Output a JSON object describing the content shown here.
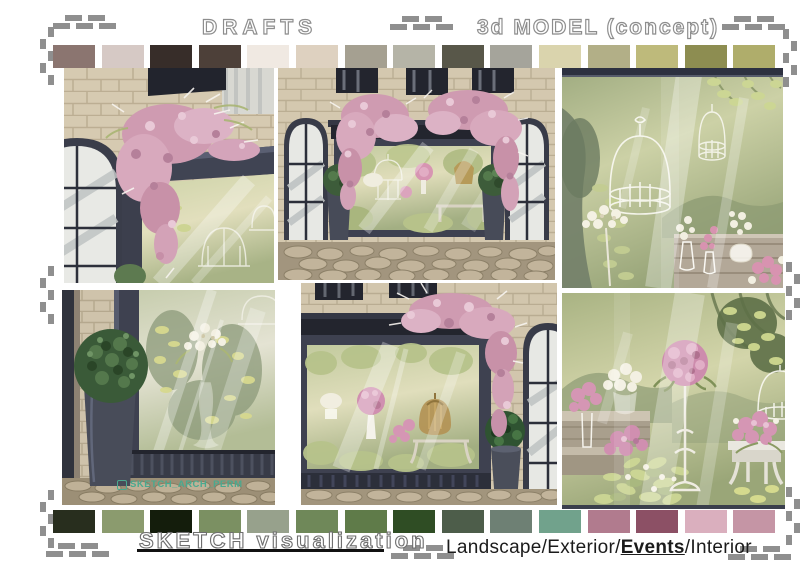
{
  "page": {
    "titles": {
      "drafts": "DRAFTS",
      "model_concept": "3d MODEL (concept)",
      "sketch_visualization": "SKETCH visualization"
    },
    "categories": {
      "prefix": "Landscape/Exterior/",
      "events": "Events",
      "suffix": "/Interior"
    },
    "watermark": "SKETCH_ARCH_PERM",
    "accent": {
      "underline": "#111111",
      "stitch": "#8f8f8f",
      "title_outline": "#8d8d8d",
      "watermark_color": "#4aa98f"
    }
  },
  "palettes": {
    "top": [
      "#8B7570",
      "#D6C9C5",
      "#372D29",
      "#4D4039",
      "#F0E9E2",
      "#DED1C0",
      "#A5A091",
      "#B5B4A7",
      "#585749",
      "#A5A49B",
      "#DAD4AD",
      "#B2AF87",
      "#BEBA7B",
      "#8D8D51",
      "#AFAD6B"
    ],
    "bottom": [
      "#282E1E",
      "#8B9B6E",
      "#141D0C",
      "#7B9062",
      "#97A18C",
      "#6F8859",
      "#5F7B49",
      "#2F4D24",
      "#4D5D4A",
      "#6E8074",
      "#71A28C",
      "#B17B8E",
      "#8C5065",
      "#DAAFBE",
      "#C595A5"
    ]
  },
  "panels": [
    {
      "id": "draft-closeup-left",
      "label": "Draft sketch: shopfront corner with pink wisteria cascading over the dark display-window frame, stone wall and arched side window"
    },
    {
      "id": "draft-full-storefront",
      "label": "Draft sketch: full flower shop storefront with large display window, wisteria on both corners, topiary planters and cobblestone pavement"
    },
    {
      "id": "model-window-display",
      "label": "3d model concept: window display interior with white birdcages, hanging greenery and flower vases on a wooden shelf"
    },
    {
      "id": "sketch-planter-closeup",
      "label": "Sketch: round topiary in tall dark planter beside the display window with a slender glass vase of white flowers"
    },
    {
      "id": "sketch-storefront-right",
      "label": "Sketch: right side of the storefront with wisteria falling over the window corner, golden cloche, bench and topiary planter"
    },
    {
      "id": "sketch-interior-display",
      "label": "Sketch: interior display with pink flower ball on an ornate white pedestal, shelves of vases, greenery and a white bench"
    }
  ]
}
